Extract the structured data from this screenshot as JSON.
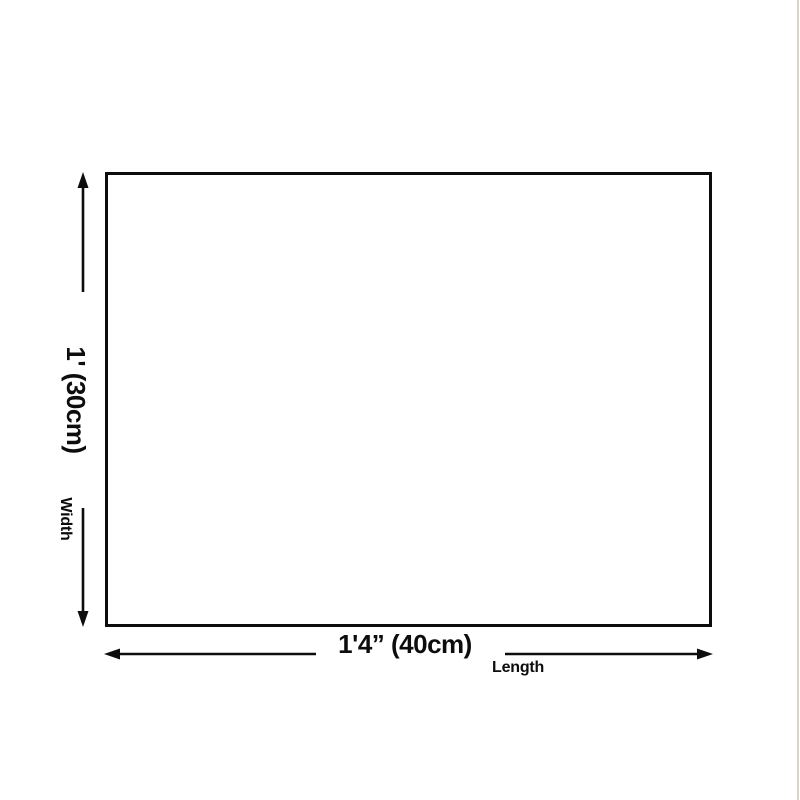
{
  "page": {
    "background_color": "#ffffff",
    "line_color": "#0d0d0d",
    "edge_line_color": "#d9d2c8"
  },
  "diagram": {
    "width_dimension": {
      "value": "1' (30cm)",
      "axis_label": "Width"
    },
    "length_dimension": {
      "value": "1'4” (40cm)",
      "axis_label": "Length"
    }
  }
}
